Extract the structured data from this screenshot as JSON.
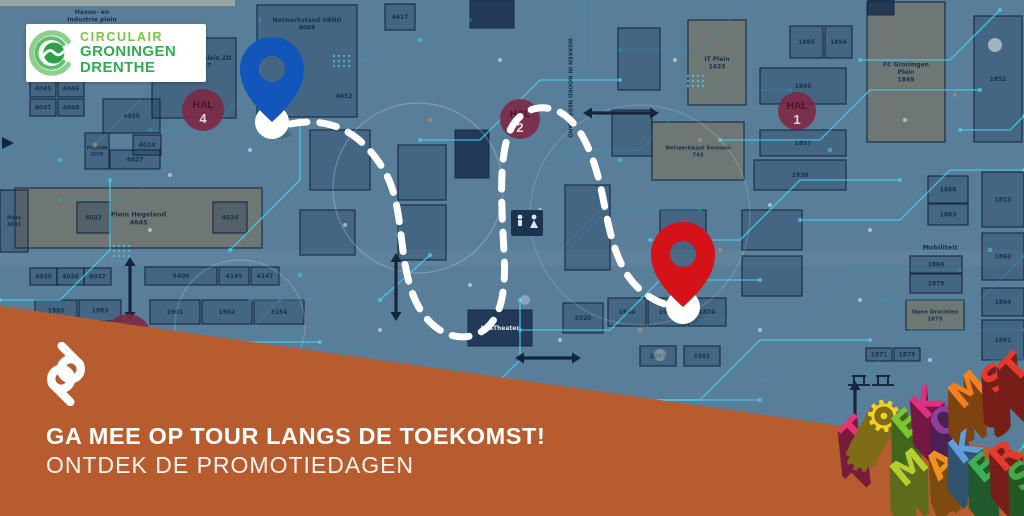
{
  "logo": {
    "line1": "CIRCULAIR",
    "line2": "GRONINGEN",
    "line3": "DRENTHE",
    "accent_light": "#7dc344",
    "accent_dark": "#2fae4e"
  },
  "banner": {
    "headline": "GA MEE OP TOUR LANGS DE TOEKOMST!",
    "subline": "ONTDEK DE PROMOTIEDAGEN",
    "monogram": "pd",
    "color": "#b75c2e"
  },
  "map": {
    "base_color": "#597e9a",
    "pins": [
      {
        "id": "blue-pin",
        "color": "#1356bb",
        "x": 272,
        "y": 122
      },
      {
        "id": "red-pin",
        "color": "#d41217",
        "x": 683,
        "y": 307
      }
    ],
    "route": {
      "color": "#ffffff",
      "width": 7,
      "dash": "17 13",
      "path": "M 290 124 C 330 116 362 132 385 172 C 404 206 398 252 412 292 C 424 327 452 344 477 334 C 503 323 506 288 504 252 C 502 212 498 162 509 133 C 519 107 545 102 563 114 C 581 126 592 152 600 184 C 607 214 610 248 628 276 C 642 296 660 303 668 305"
    },
    "hal_markers": [
      {
        "x": 203,
        "y": 110,
        "r": 21,
        "top": "HAL",
        "num": "4"
      },
      {
        "x": 520,
        "y": 119,
        "r": 20,
        "top": "HAL",
        "num": "2"
      },
      {
        "x": 797,
        "y": 111,
        "r": 19,
        "top": "HAL",
        "num": "1"
      },
      {
        "x": 128,
        "y": 337,
        "r": 23,
        "top": "",
        "num": ""
      }
    ],
    "labels": [
      {
        "text": "Haven- en\nIndustrie plein",
        "x": 92,
        "y": 8,
        "fs": 6
      },
      {
        "text": "Netwerkplein ZD\n4657",
        "x": 203,
        "y": 54,
        "fs": 6
      },
      {
        "text": "Netwerkstand VBNO\n4068",
        "x": 307,
        "y": 16,
        "fs": 6
      },
      {
        "text": "4052",
        "x": 344,
        "y": 92,
        "fs": 6
      },
      {
        "text": "WERKEN IN NOORD NEDERLAND",
        "x": 574,
        "y": 88,
        "fs": 5.5,
        "vertical": true
      },
      {
        "text": "Mobiliteit",
        "x": 940,
        "y": 243,
        "fs": 6.5
      },
      {
        "text": "INGANG",
        "x": 856,
        "y": 426,
        "fs": 6
      }
    ],
    "stands": [
      {
        "x": 30,
        "y": 80,
        "w": 26,
        "h": 17,
        "label": "4045"
      },
      {
        "x": 58,
        "y": 80,
        "w": 26,
        "h": 17,
        "label": "4046"
      },
      {
        "x": 30,
        "y": 99,
        "w": 26,
        "h": 17,
        "label": "4047"
      },
      {
        "x": 58,
        "y": 99,
        "w": 26,
        "h": 17,
        "label": "4048"
      },
      {
        "x": 103,
        "y": 99,
        "w": 57,
        "h": 34,
        "label": "4035"
      },
      {
        "x": 133,
        "y": 135,
        "w": 28,
        "h": 20,
        "label": "4024"
      },
      {
        "x": 85,
        "y": 133,
        "w": 24,
        "h": 36,
        "label": "PODIUM\n4028",
        "fs": 4.5
      },
      {
        "x": 110,
        "y": 150,
        "w": 50,
        "h": 19,
        "label": "4027"
      },
      {
        "x": 15,
        "y": 188,
        "w": 247,
        "h": 60,
        "label": "Plein Hegeland\n4845",
        "t": "b",
        "fs": 6.5
      },
      {
        "x": 77,
        "y": 202,
        "w": 33,
        "h": 31,
        "label": "4032"
      },
      {
        "x": 213,
        "y": 202,
        "w": 34,
        "h": 31,
        "label": "4034"
      },
      {
        "x": 0,
        "y": 190,
        "w": 28,
        "h": 62,
        "label": "Plein\n4881",
        "fs": 5
      },
      {
        "x": 30,
        "y": 268,
        "w": 27,
        "h": 17,
        "label": "4035"
      },
      {
        "x": 57,
        "y": 268,
        "w": 27,
        "h": 17,
        "label": "4036"
      },
      {
        "x": 84,
        "y": 268,
        "w": 27,
        "h": 17,
        "label": "4037"
      },
      {
        "x": 35,
        "y": 300,
        "w": 42,
        "h": 21,
        "label": "1993"
      },
      {
        "x": 79,
        "y": 300,
        "w": 42,
        "h": 21,
        "label": "1983"
      },
      {
        "x": 145,
        "y": 267,
        "w": 72,
        "h": 18,
        "label": "5400"
      },
      {
        "x": 219,
        "y": 267,
        "w": 30,
        "h": 18,
        "label": "4145"
      },
      {
        "x": 251,
        "y": 267,
        "w": 28,
        "h": 18,
        "label": "4147"
      },
      {
        "x": 150,
        "y": 300,
        "w": 50,
        "h": 24,
        "label": "1901"
      },
      {
        "x": 202,
        "y": 300,
        "w": 50,
        "h": 24,
        "label": "1902"
      },
      {
        "x": 254,
        "y": 300,
        "w": 50,
        "h": 24,
        "label": "3154"
      },
      {
        "x": 152,
        "y": 38,
        "w": 84,
        "h": 80
      },
      {
        "x": 257,
        "y": 5,
        "w": 100,
        "h": 112
      },
      {
        "x": 385,
        "y": 4,
        "w": 30,
        "h": 26,
        "label": "4617"
      },
      {
        "x": 310,
        "y": 130,
        "w": 60,
        "h": 60
      },
      {
        "x": 300,
        "y": 210,
        "w": 55,
        "h": 45
      },
      {
        "x": 398,
        "y": 145,
        "w": 48,
        "h": 55
      },
      {
        "x": 398,
        "y": 205,
        "w": 48,
        "h": 55
      },
      {
        "x": 455,
        "y": 130,
        "w": 34,
        "h": 48,
        "dark": true
      },
      {
        "x": 565,
        "y": 185,
        "w": 45,
        "h": 85
      },
      {
        "x": 612,
        "y": 110,
        "w": 40,
        "h": 46
      },
      {
        "x": 618,
        "y": 28,
        "w": 42,
        "h": 62
      },
      {
        "x": 660,
        "y": 210,
        "w": 46,
        "h": 60
      },
      {
        "x": 742,
        "y": 210,
        "w": 60,
        "h": 40
      },
      {
        "x": 742,
        "y": 256,
        "w": 60,
        "h": 40
      },
      {
        "x": 688,
        "y": 20,
        "w": 58,
        "h": 85,
        "t": "b",
        "label": "IT Plein\n1633",
        "fs": 6
      },
      {
        "x": 652,
        "y": 122,
        "w": 92,
        "h": 58,
        "t": "b",
        "label": "Netwerkkast Eemsen\n742",
        "fs": 5.5
      },
      {
        "x": 867,
        "y": 2,
        "w": 78,
        "h": 140,
        "t": "b",
        "label": "FC Groningen\nPlein\n1849",
        "fs": 6
      },
      {
        "x": 790,
        "y": 26,
        "w": 33,
        "h": 32,
        "label": "1865"
      },
      {
        "x": 825,
        "y": 26,
        "w": 27,
        "h": 32,
        "label": "1854"
      },
      {
        "x": 760,
        "y": 68,
        "w": 86,
        "h": 36,
        "label": "1845"
      },
      {
        "x": 760,
        "y": 130,
        "w": 86,
        "h": 26,
        "label": "1857"
      },
      {
        "x": 754,
        "y": 160,
        "w": 92,
        "h": 30,
        "label": "1830"
      },
      {
        "x": 974,
        "y": 16,
        "w": 48,
        "h": 126,
        "label": "1852"
      },
      {
        "x": 928,
        "y": 176,
        "w": 40,
        "h": 27,
        "label": "1868"
      },
      {
        "x": 928,
        "y": 204,
        "w": 40,
        "h": 21,
        "label": "1863"
      },
      {
        "x": 910,
        "y": 256,
        "w": 52,
        "h": 17,
        "label": "1869"
      },
      {
        "x": 910,
        "y": 274,
        "w": 52,
        "h": 19,
        "label": "1879"
      },
      {
        "x": 906,
        "y": 300,
        "w": 58,
        "h": 30,
        "t": "b",
        "label": "Open Drachten\n1875",
        "fs": 5.5
      },
      {
        "x": 982,
        "y": 172,
        "w": 42,
        "h": 55,
        "label": "1813"
      },
      {
        "x": 982,
        "y": 233,
        "w": 42,
        "h": 47,
        "label": "1862"
      },
      {
        "x": 982,
        "y": 288,
        "w": 42,
        "h": 28,
        "label": "1864"
      },
      {
        "x": 982,
        "y": 320,
        "w": 42,
        "h": 40,
        "label": "1861"
      },
      {
        "x": 468,
        "y": 310,
        "w": 64,
        "h": 36,
        "dark": true,
        "label": "KasTheater",
        "fs": 6,
        "white": true
      },
      {
        "x": 563,
        "y": 303,
        "w": 40,
        "h": 30,
        "label": "2020"
      },
      {
        "x": 608,
        "y": 298,
        "w": 38,
        "h": 28,
        "label": "1544"
      },
      {
        "x": 648,
        "y": 298,
        "w": 38,
        "h": 28,
        "label": "1911"
      },
      {
        "x": 688,
        "y": 298,
        "w": 38,
        "h": 28,
        "label": "1874"
      },
      {
        "x": 640,
        "y": 346,
        "w": 36,
        "h": 20,
        "label": "1891"
      },
      {
        "x": 684,
        "y": 346,
        "w": 36,
        "h": 20,
        "label": "1901"
      },
      {
        "x": 866,
        "y": 348,
        "w": 26,
        "h": 13,
        "label": "1872"
      },
      {
        "x": 894,
        "y": 348,
        "w": 26,
        "h": 13,
        "label": "1875"
      },
      {
        "x": 470,
        "y": 0,
        "w": 44,
        "h": 28,
        "dark": true
      },
      {
        "x": 868,
        "y": 0,
        "w": 26,
        "h": 15,
        "dark": true
      }
    ]
  },
  "letters": {
    "row1": [
      {
        "ch": "T",
        "color": "#e8356f",
        "x": 856,
        "y": 432,
        "rot": -45,
        "size": 36
      },
      {
        "ch": "⚙",
        "color": "#f2cf2a",
        "x": 884,
        "y": 417,
        "rot": -10,
        "size": 44,
        "gear": true
      },
      {
        "ch": "E",
        "color": "#7cc431",
        "x": 907,
        "y": 424,
        "rot": -40,
        "size": 36
      },
      {
        "ch": "K",
        "color": "#df2f80",
        "x": 927,
        "y": 403,
        "rot": -44,
        "size": 36
      },
      {
        "ch": "O",
        "color": "#8e3f9e",
        "x": 946,
        "y": 421,
        "rot": -38,
        "size": 36
      },
      {
        "ch": "M",
        "color": "#f08020",
        "x": 968,
        "y": 390,
        "rot": -40,
        "size": 36
      },
      {
        "ch": "S",
        "color": "#e23a2e",
        "x": 996,
        "y": 378,
        "rot": -42,
        "size": 36
      },
      {
        "ch": "T",
        "color": "#e23a2e",
        "x": 1015,
        "y": 368,
        "rot": -45,
        "size": 36
      }
    ],
    "row2": [
      {
        "ch": "M",
        "color": "#b5cf33",
        "x": 910,
        "y": 468,
        "rot": -40,
        "size": 36
      },
      {
        "ch": "A",
        "color": "#f09020",
        "x": 941,
        "y": 464,
        "rot": -42,
        "size": 36
      },
      {
        "ch": "K",
        "color": "#5e9fd8",
        "x": 965,
        "y": 448,
        "rot": -38,
        "size": 36
      },
      {
        "ch": "E",
        "color": "#3fae57",
        "x": 984,
        "y": 468,
        "rot": -40,
        "size": 36
      },
      {
        "ch": "R",
        "color": "#e23a2e",
        "x": 1006,
        "y": 456,
        "rot": -42,
        "size": 36
      },
      {
        "ch": "S",
        "color": "#48a848",
        "x": 1023,
        "y": 476,
        "rot": -40,
        "size": 36
      }
    ]
  }
}
